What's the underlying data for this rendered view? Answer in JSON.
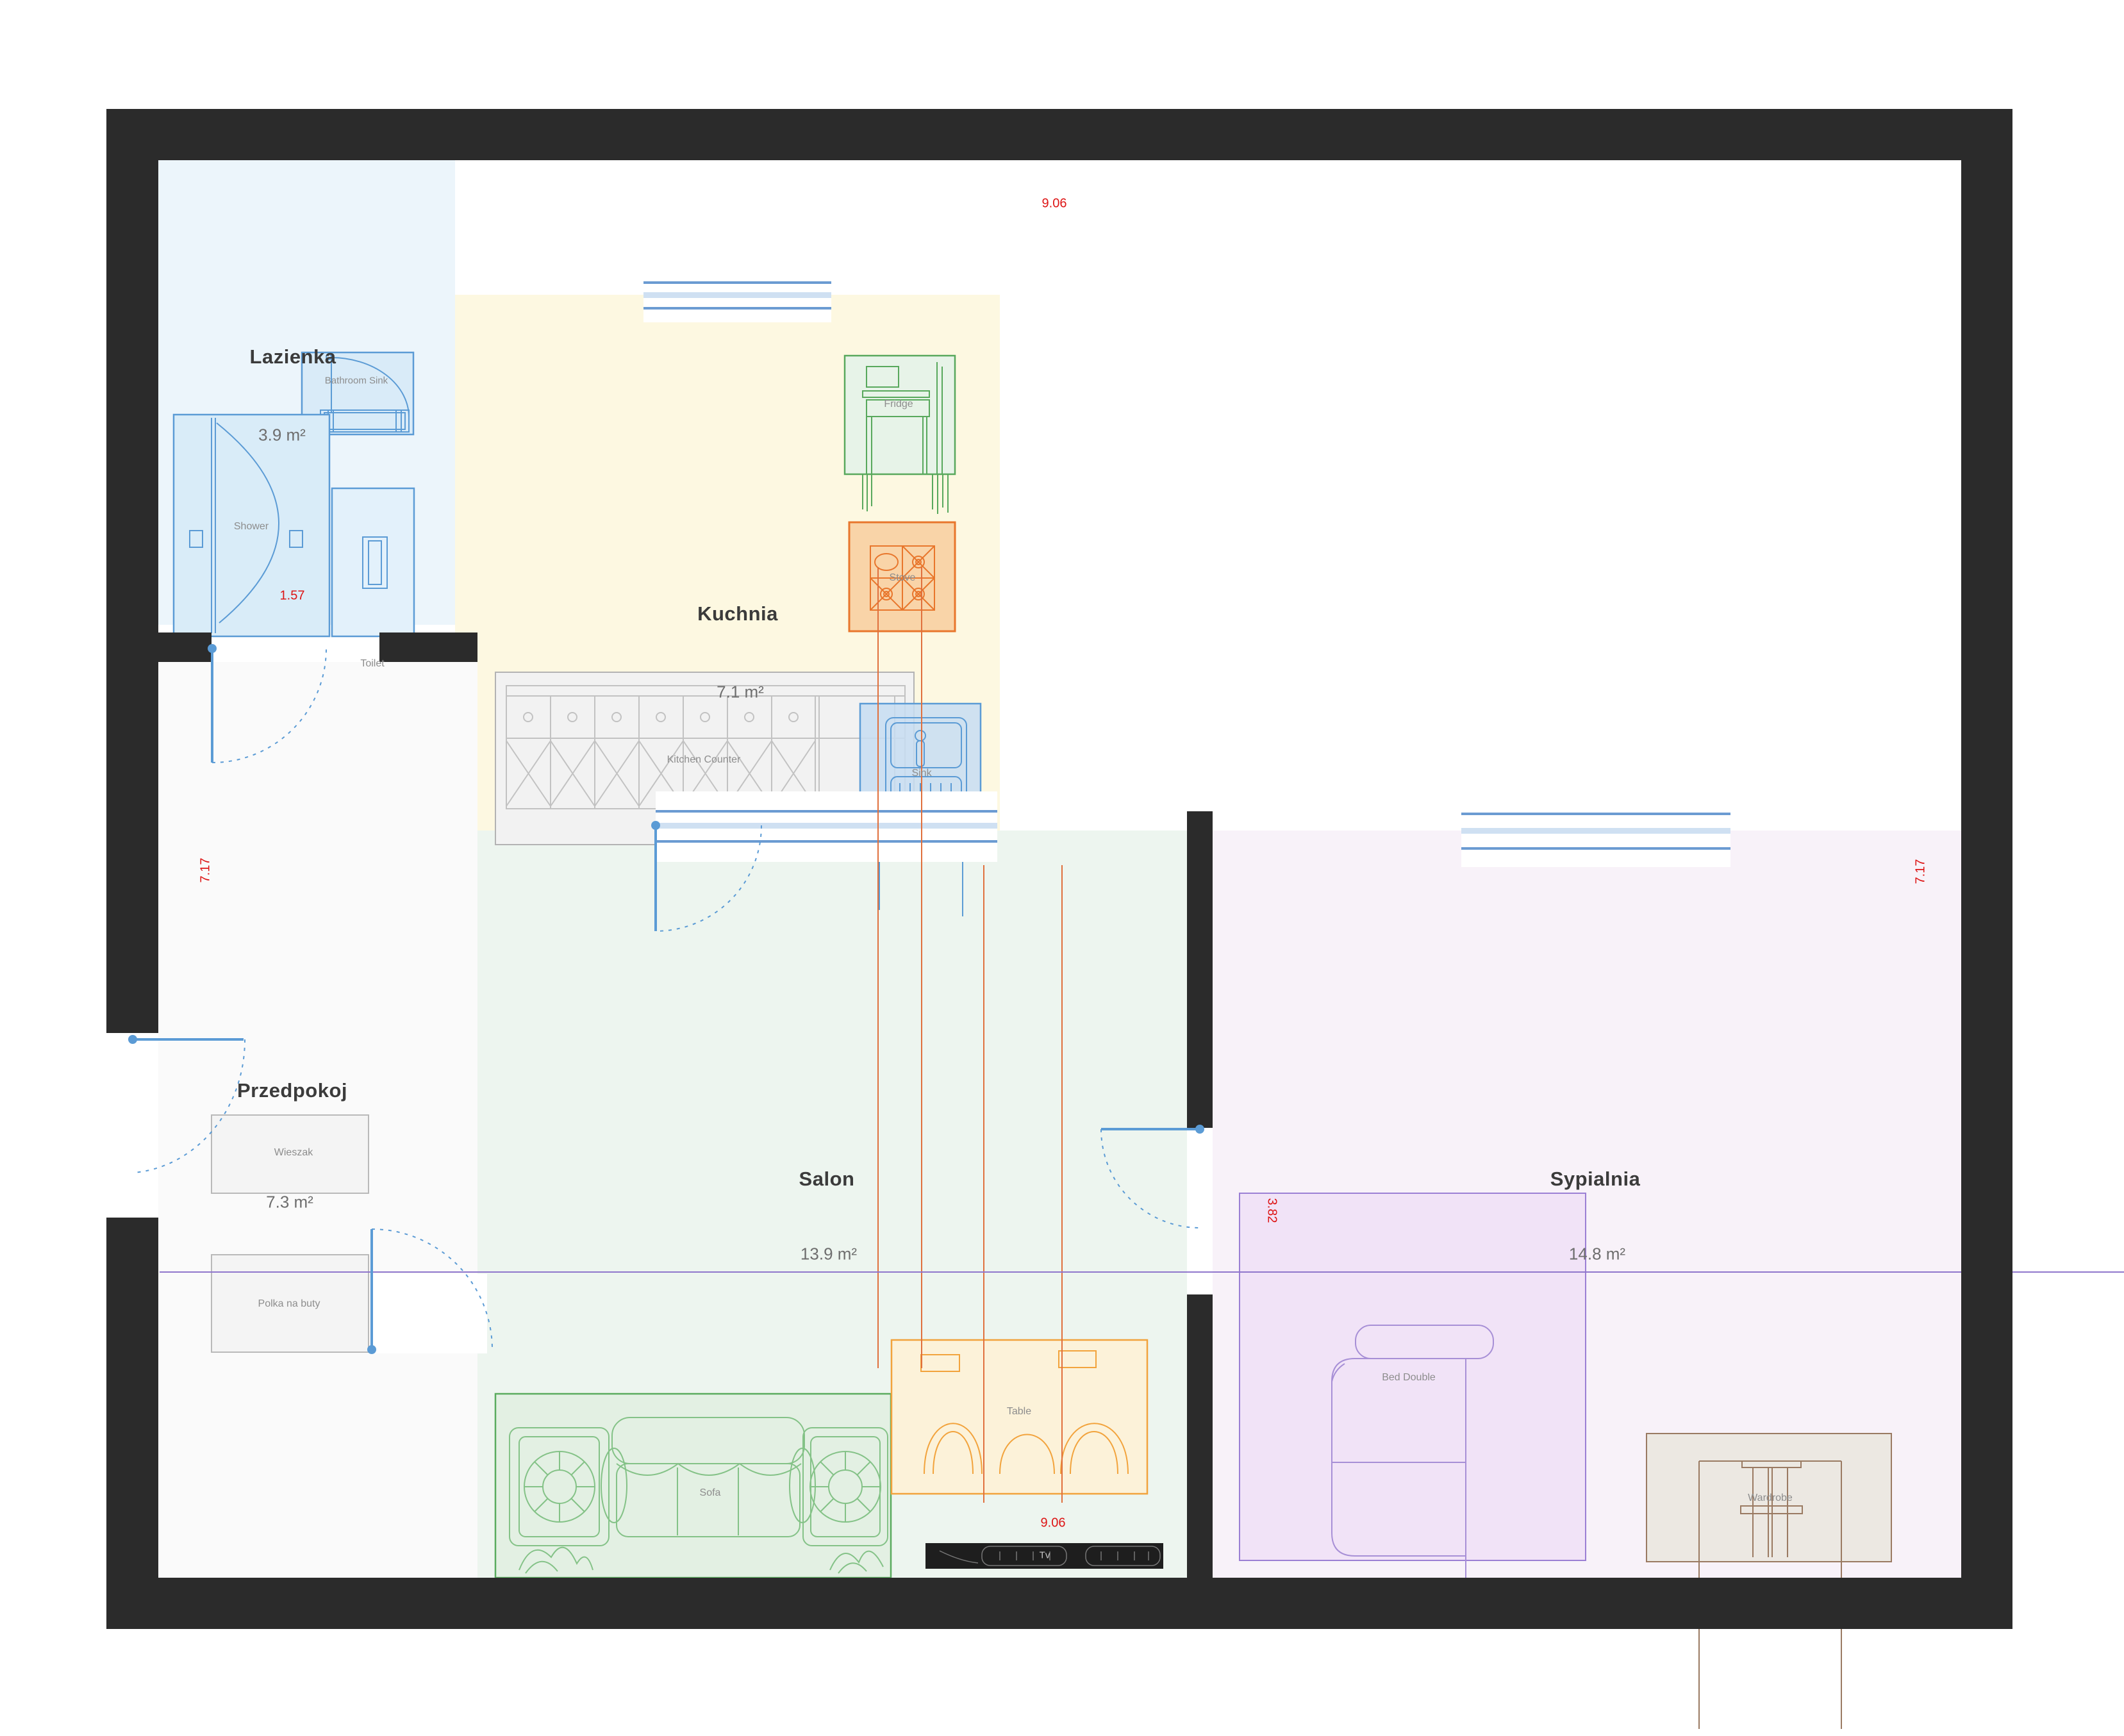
{
  "plan": {
    "rooms": [
      {
        "id": "lazienka",
        "name": "Lazienka",
        "area": "3.9 m²"
      },
      {
        "id": "kuchnia",
        "name": "Kuchnia",
        "area": "7.1 m²"
      },
      {
        "id": "przedpokoj",
        "name": "Przedpokoj",
        "area": "7.3 m²"
      },
      {
        "id": "salon",
        "name": "Salon",
        "area": "13.9 m²"
      },
      {
        "id": "sypialnia",
        "name": "Sypialnia",
        "area": "14.8 m²"
      }
    ],
    "furniture": {
      "bathroom_sink": "Bathroom Sink",
      "shower": "Shower",
      "toilet": "Toilet",
      "fridge": "Fridge",
      "stove": "Stove",
      "kitchen_counter": "Kitchen Counter",
      "sink": "Sink",
      "wieszak": "Wieszak",
      "polka_na_buty": "Polka na buty",
      "sofa": "Sofa",
      "table": "Table",
      "tv": "Tv",
      "bed": "Bed Double",
      "wardrobe": "Wardrobe"
    },
    "dimensions": {
      "top": "9.06",
      "bottom": "9.06",
      "left": "7.17",
      "right": "7.17",
      "bathroom_door": "1.57",
      "bedroom_width": "3.82"
    },
    "colors": {
      "wall": "#2b2b2b",
      "accent_blue": "#5b9bd5",
      "accent_green": "#55a85a",
      "accent_orange": "#f2a33c",
      "accent_red": "#dd1414",
      "accent_purple": "#8f76cc",
      "accent_brown": "#9a7a62",
      "room_bathroom": "#ecf5fb",
      "room_kitchen": "#fdf8e1",
      "room_hall": "#fafafa",
      "room_salon": "#edf5ef",
      "room_bedroom": "#f8f2f9"
    }
  }
}
